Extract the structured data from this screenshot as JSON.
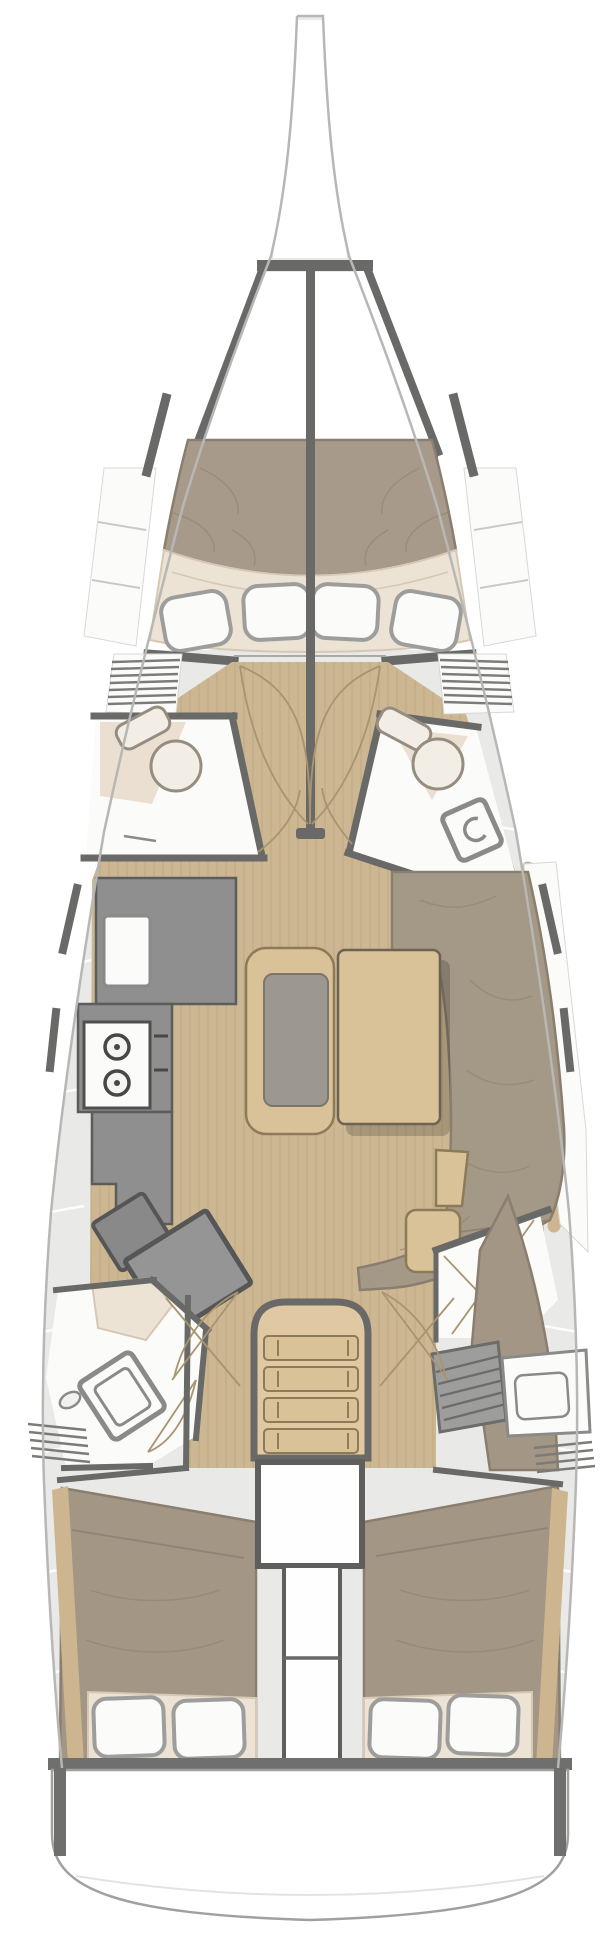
{
  "meta": {
    "aria_label": "Sailboat interior deck plan, top-down view",
    "diagram_type": "boat-floorplan"
  },
  "colors": {
    "bg": "#ffffff",
    "hull_line": "#b7b7b5",
    "deck": "#e9e9e8",
    "deck_gap": "#ffffff",
    "wall_dark": "#696968",
    "wood_floor": "#cdb793",
    "wood_floor_line": "#b59e77",
    "wood_furniture": "#d9c198",
    "wood_edge": "#8d7a58",
    "stairs_wood": "#e0c9a2",
    "mattress": "#a89a8b",
    "bed": "#a39685",
    "sofa": "#a49887",
    "upholstery_line": "#8a7e6e",
    "cream": "#ece3d5",
    "cream_line": "#d6c8b3",
    "pillow": "#fbfbfa",
    "pillow_line": "#9d9d9b",
    "counter": "#8f8f8f",
    "counter_dark": "#5c5c5b",
    "desk": "#959595",
    "seat": "#898989",
    "cushion": "#9c9890",
    "fixture": "#fbfbfa",
    "fixture_line": "#8a8a88",
    "toilet": "#f2ede5",
    "toilet_line": "#968d80",
    "louver": "#7b7b79",
    "hatch": "#9d9d9c",
    "hatch_line": "#6c6c6b",
    "door_arc": "#a8946f",
    "wrinkle": "#92866f",
    "shadow": "rgba(0,0,0,0.18)",
    "engine_line": "#5e5e5c",
    "platform_line": "#a0a09f",
    "trim_wood": "#cdb68f"
  },
  "vessel": {
    "zones": [
      {
        "id": "bow",
        "name": "bow and forestay fitting"
      },
      {
        "id": "anchor-locker",
        "name": "anchor locker"
      },
      {
        "id": "forward-cabin",
        "name": "forward cabin with double V-berth"
      },
      {
        "id": "port-head",
        "name": "port forward head with toilet"
      },
      {
        "id": "starboard-head",
        "name": "starboard forward head with toilet and shower"
      },
      {
        "id": "saloon",
        "name": "saloon with L-sofa, table and centre bench"
      },
      {
        "id": "galley",
        "name": "port galley with two-burner stove and sink"
      },
      {
        "id": "nav-station",
        "name": "chart table with seat"
      },
      {
        "id": "port-aft-head",
        "name": "port aft head with shower and washbasin"
      },
      {
        "id": "companionway",
        "name": "companionway stairs"
      },
      {
        "id": "engine",
        "name": "engine compartment"
      },
      {
        "id": "port-aft-cabin",
        "name": "port aft double cabin"
      },
      {
        "id": "starboard-aft-cabin",
        "name": "starboard aft double cabin with vanity and locker"
      },
      {
        "id": "transom",
        "name": "transom swim platform"
      }
    ],
    "counts": {
      "forward_berth_foot_panels": 4,
      "stove_burners": 2,
      "stair_treads": 4,
      "pillows_per_aft_cabin": 2,
      "toilets": 2,
      "showers": 2
    }
  }
}
